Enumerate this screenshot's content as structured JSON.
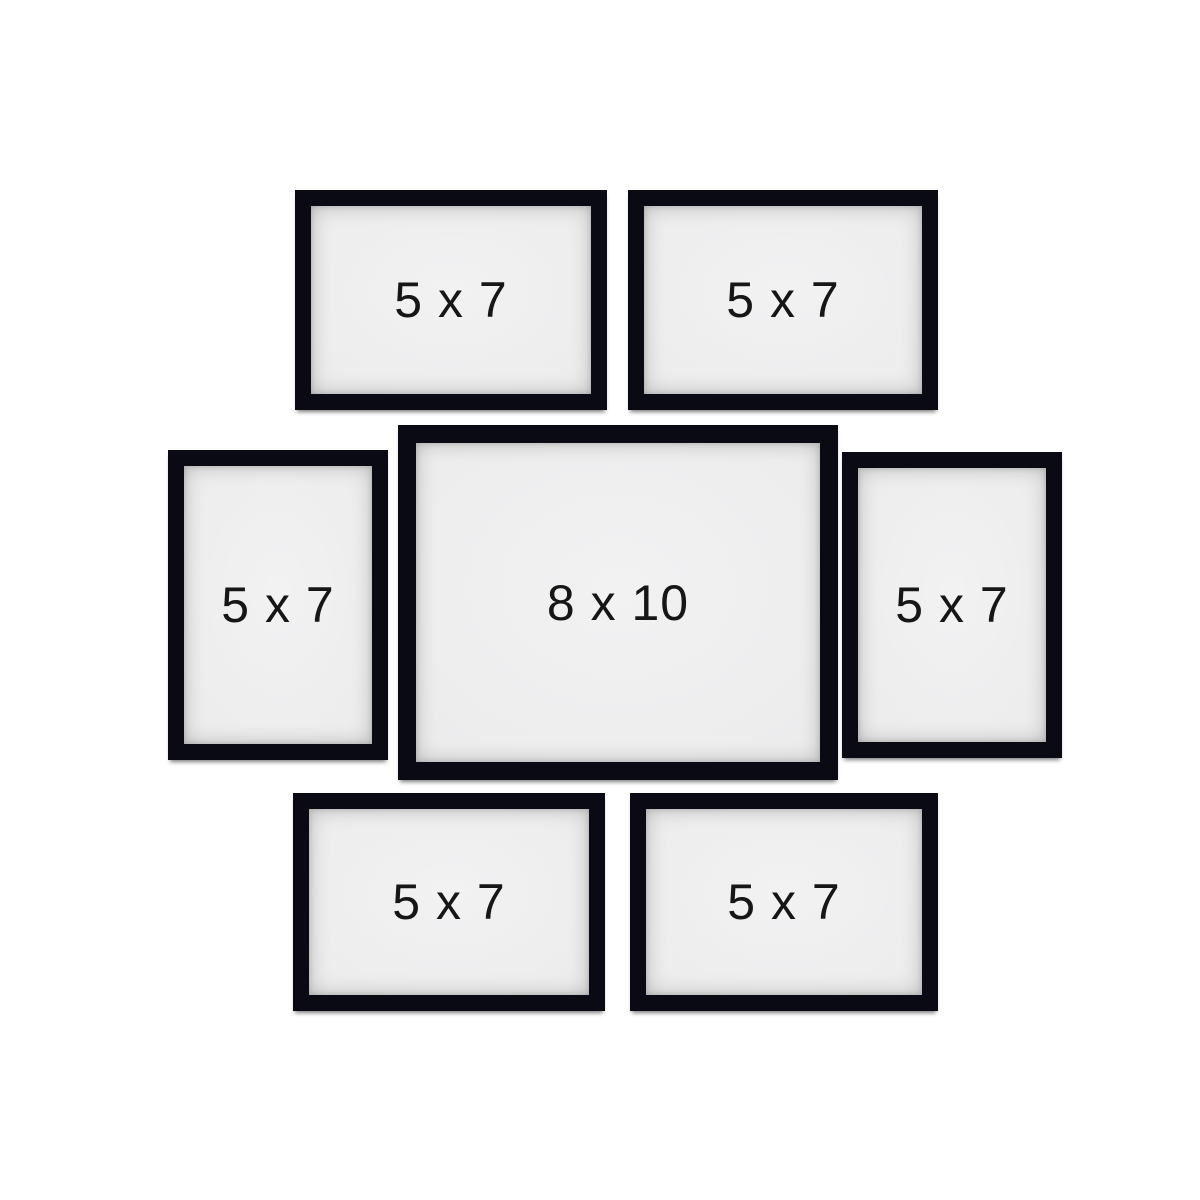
{
  "colors": {
    "background": "#ffffff",
    "frame": "#0a0a14",
    "mat": "#ececed",
    "label_text": "#161616"
  },
  "frames": [
    {
      "name": "top-left",
      "label": "5 x 7"
    },
    {
      "name": "top-right",
      "label": "5 x 7"
    },
    {
      "name": "middle-left",
      "label": "5 x 7"
    },
    {
      "name": "center",
      "label": "8 x 10"
    },
    {
      "name": "middle-right",
      "label": "5 x 7"
    },
    {
      "name": "bottom-left",
      "label": "5 x 7"
    },
    {
      "name": "bottom-right",
      "label": "5 x 7"
    }
  ]
}
